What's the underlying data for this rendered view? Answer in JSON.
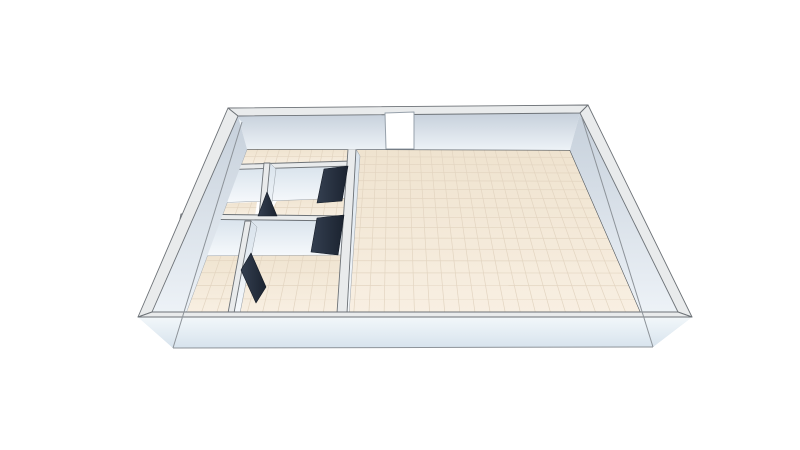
{
  "app": {
    "canvas_label": "3D floor plan perspective view",
    "accent": "#232c39"
  },
  "scene": {
    "background": "#ffffff",
    "palette": {
      "floor_top": "#efe3cf",
      "floor_bottom": "#f8efe2",
      "floor_grid": "#e3d5c1",
      "wall_inner_top": "#c6d0db",
      "wall_inner_bottom": "#edf2f7",
      "wall_inner_light_top": "#d9e3ec",
      "wall_inner_light_bottom": "#f6f9fc",
      "crest": "#e9ebec",
      "edge": "#6d7277",
      "outer_front_top": "#f2f7fa",
      "outer_front_bottom": "#d7e3ed",
      "outer_side_top": "#f1f6fa",
      "outer_side_bottom": "#cfdde9",
      "door_left": "#343f50",
      "door_right": "#1b2330",
      "door_edge": "#131a25",
      "opening_fill": "#ffffff",
      "opening_stroke": "#97a1ab",
      "foot_dark": "#50565c",
      "foot_light": "#9aa1a8",
      "base_line": "#8d9399"
    },
    "floor_grid": {
      "cols": 30,
      "rows": 16,
      "quad": [
        [
          247,
          149
        ],
        [
          570,
          150
        ],
        [
          641,
          313
        ],
        [
          186,
          313
        ]
      ]
    },
    "floors": [
      {
        "name": "room-floor-living-room",
        "pts": [
          [
            356,
            150
          ],
          [
            570,
            150
          ],
          [
            641,
            313
          ],
          [
            347,
            313
          ]
        ]
      },
      {
        "name": "room-floor-top-left",
        "pts": [
          [
            238,
            149
          ],
          [
            352,
            149
          ],
          [
            350,
            164
          ],
          [
            229,
            166
          ]
        ]
      },
      {
        "name": "room-floor-mid-left",
        "pts": [
          [
            214,
            204
          ],
          [
            257,
            202
          ],
          [
            255,
            216
          ],
          [
            211,
            216
          ]
        ]
      },
      {
        "name": "room-floor-mid-center",
        "pts": [
          [
            277,
            201
          ],
          [
            347,
            195
          ],
          [
            346,
            218
          ],
          [
            267,
            217
          ]
        ]
      },
      {
        "name": "room-floor-bottom-left",
        "pts": [
          [
            201,
            253
          ],
          [
            246,
            251
          ],
          [
            233,
            313
          ],
          [
            187,
            313
          ]
        ]
      },
      {
        "name": "room-floor-bottom-center",
        "pts": [
          [
            250,
            252
          ],
          [
            342,
            249
          ],
          [
            337,
            313
          ],
          [
            236,
            313
          ]
        ]
      }
    ],
    "foot_lines": [
      {
        "name": "foot-back-wall",
        "pts": [
          [
            247,
            149
          ],
          [
            570,
            150
          ]
        ],
        "tone": "dark"
      },
      {
        "name": "foot-right-wall",
        "pts": [
          [
            570,
            150
          ],
          [
            641,
            313
          ]
        ],
        "tone": "dark"
      },
      {
        "name": "foot-left-wall",
        "pts": [
          [
            247,
            149
          ],
          [
            186,
            313
          ]
        ],
        "tone": "light"
      },
      {
        "name": "foot-wall-upper",
        "pts": [
          [
            213,
            202
          ],
          [
            349,
            196
          ]
        ],
        "tone": "light"
      },
      {
        "name": "foot-wall-lower",
        "pts": [
          [
            177,
            255
          ],
          [
            343,
            254
          ]
        ],
        "tone": "light"
      },
      {
        "name": "foot-wall-main",
        "pts": [
          [
            359,
            156
          ],
          [
            348,
            314
          ]
        ],
        "tone": "light"
      },
      {
        "name": "foot-divider-d",
        "pts": [
          [
            256,
            227
          ],
          [
            240,
            312
          ]
        ],
        "tone": "light"
      }
    ],
    "interior_walls": [
      {
        "name": "wall-interior-upper-horizontal",
        "crest": [
          [
            216,
            165
          ],
          [
            352,
            161
          ],
          [
            352,
            166
          ],
          [
            215,
            170
          ]
        ],
        "face": [
          [
            215,
            170
          ],
          [
            352,
            166
          ],
          [
            350,
            198
          ],
          [
            211,
            203
          ]
        ]
      },
      {
        "name": "wall-interior-divider-c",
        "crest": [
          [
            264,
            163
          ],
          [
            270,
            163
          ],
          [
            265,
            217
          ],
          [
            259,
            217
          ]
        ],
        "face": [
          [
            270,
            163
          ],
          [
            276,
            169
          ],
          [
            270,
            217
          ],
          [
            265,
            217
          ]
        ]
      },
      {
        "name": "wall-interior-lower-horizontal",
        "crest": [
          [
            181,
            214
          ],
          [
            348,
            216
          ],
          [
            348,
            221
          ],
          [
            180,
            219
          ]
        ],
        "face": [
          [
            180,
            219
          ],
          [
            348,
            221
          ],
          [
            344,
            255
          ],
          [
            176,
            256
          ]
        ]
      },
      {
        "name": "wall-interior-divider-d",
        "crest": [
          [
            245,
            221
          ],
          [
            251,
            221
          ],
          [
            234,
            313
          ],
          [
            228,
            313
          ]
        ],
        "face": [
          [
            251,
            221
          ],
          [
            257,
            227
          ],
          [
            240,
            313
          ],
          [
            234,
            313
          ]
        ]
      },
      {
        "name": "wall-interior-main-vertical",
        "crest": [
          [
            348,
            149
          ],
          [
            356,
            149
          ],
          [
            347,
            313
          ],
          [
            337,
            313
          ]
        ],
        "face": [
          [
            356,
            149
          ],
          [
            360,
            156
          ],
          [
            349,
            315
          ],
          [
            347,
            313
          ]
        ]
      }
    ],
    "doors": [
      {
        "name": "door-leaf-upper",
        "pts": [
          [
            324,
            169
          ],
          [
            348,
            166
          ],
          [
            342,
            201
          ],
          [
            317,
            203
          ]
        ]
      },
      {
        "name": "door-leaf-lower",
        "pts": [
          [
            317,
            218
          ],
          [
            344,
            215
          ],
          [
            338,
            255
          ],
          [
            311,
            252
          ]
        ]
      },
      {
        "name": "door-leaf-bottom",
        "pts": [
          [
            251,
            253
          ],
          [
            266,
            287
          ],
          [
            256,
            303
          ],
          [
            241,
            270
          ]
        ]
      },
      {
        "name": "door-leaf-small",
        "pts": [
          [
            267,
            192
          ],
          [
            277,
            216
          ],
          [
            258,
            216
          ]
        ]
      }
    ],
    "outer_walls": {
      "back": {
        "name": "wall-back",
        "crest": [
          [
            228,
            108
          ],
          [
            588,
            105
          ],
          [
            580,
            113
          ],
          [
            238,
            116
          ]
        ],
        "face": [
          [
            238,
            116
          ],
          [
            580,
            113
          ],
          [
            570,
            150
          ],
          [
            247,
            149
          ]
        ],
        "opening": {
          "name": "door-opening-back-wall",
          "pts": [
            [
              385,
              113
            ],
            [
              414,
              112
            ],
            [
              414,
              149
            ],
            [
              386,
              149
            ]
          ]
        }
      },
      "left": {
        "name": "wall-left",
        "outer_face": [
          [
            228,
            108
          ],
          [
            138,
            317
          ],
          [
            173,
            348
          ],
          [
            242,
            122
          ]
        ],
        "crest": [
          [
            228,
            108
          ],
          [
            138,
            317
          ],
          [
            152,
            312
          ],
          [
            238,
            116
          ]
        ],
        "face": [
          [
            238,
            116
          ],
          [
            152,
            312
          ],
          [
            186,
            313
          ],
          [
            247,
            149
          ]
        ]
      },
      "right": {
        "name": "wall-right",
        "outer_face": [
          [
            588,
            105
          ],
          [
            692,
            317
          ],
          [
            653,
            347
          ],
          [
            582,
            118
          ]
        ],
        "crest": [
          [
            588,
            105
          ],
          [
            692,
            317
          ],
          [
            678,
            312
          ],
          [
            580,
            113
          ]
        ],
        "face": [
          [
            580,
            113
          ],
          [
            678,
            312
          ],
          [
            641,
            313
          ],
          [
            570,
            150
          ]
        ]
      },
      "front": {
        "name": "wall-front",
        "outer_face": [
          [
            138,
            317
          ],
          [
            692,
            317
          ],
          [
            653,
            347
          ],
          [
            173,
            348
          ]
        ],
        "crest": [
          [
            138,
            317
          ],
          [
            692,
            317
          ],
          [
            678,
            312
          ],
          [
            152,
            312
          ]
        ]
      }
    },
    "base_lines": [
      {
        "name": "base-front",
        "pts": [
          [
            173,
            348
          ],
          [
            653,
            347
          ]
        ]
      },
      {
        "name": "base-left",
        "pts": [
          [
            173,
            348
          ],
          [
            242,
            122
          ]
        ]
      },
      {
        "name": "base-right",
        "pts": [
          [
            653,
            347
          ],
          [
            582,
            118
          ]
        ]
      }
    ]
  }
}
